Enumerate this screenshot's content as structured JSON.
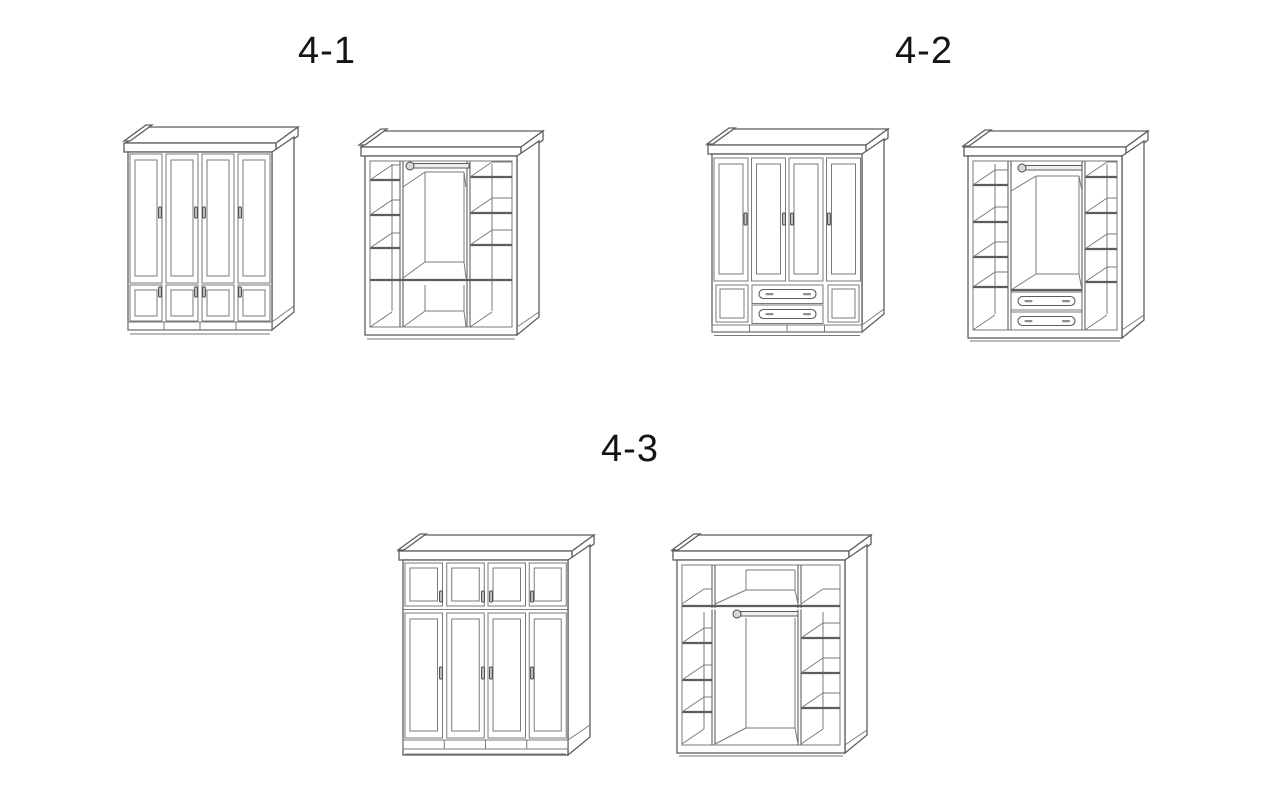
{
  "page": {
    "background": "#ffffff",
    "type": "furniture-wardrobe-diagram-sheet"
  },
  "colors": {
    "line": "#5d5d5d",
    "thin_line": "#7a7a7a",
    "text": "#141414"
  },
  "sections": [
    {
      "id": "fig-4-1",
      "label": "4-1",
      "views": [
        "exterior-closed",
        "interior-open"
      ]
    },
    {
      "id": "fig-4-2",
      "label": "4-2",
      "views": [
        "exterior-closed",
        "interior-open"
      ]
    },
    {
      "id": "fig-4-3",
      "label": "4-3",
      "views": [
        "exterior-closed",
        "interior-open"
      ]
    }
  ]
}
